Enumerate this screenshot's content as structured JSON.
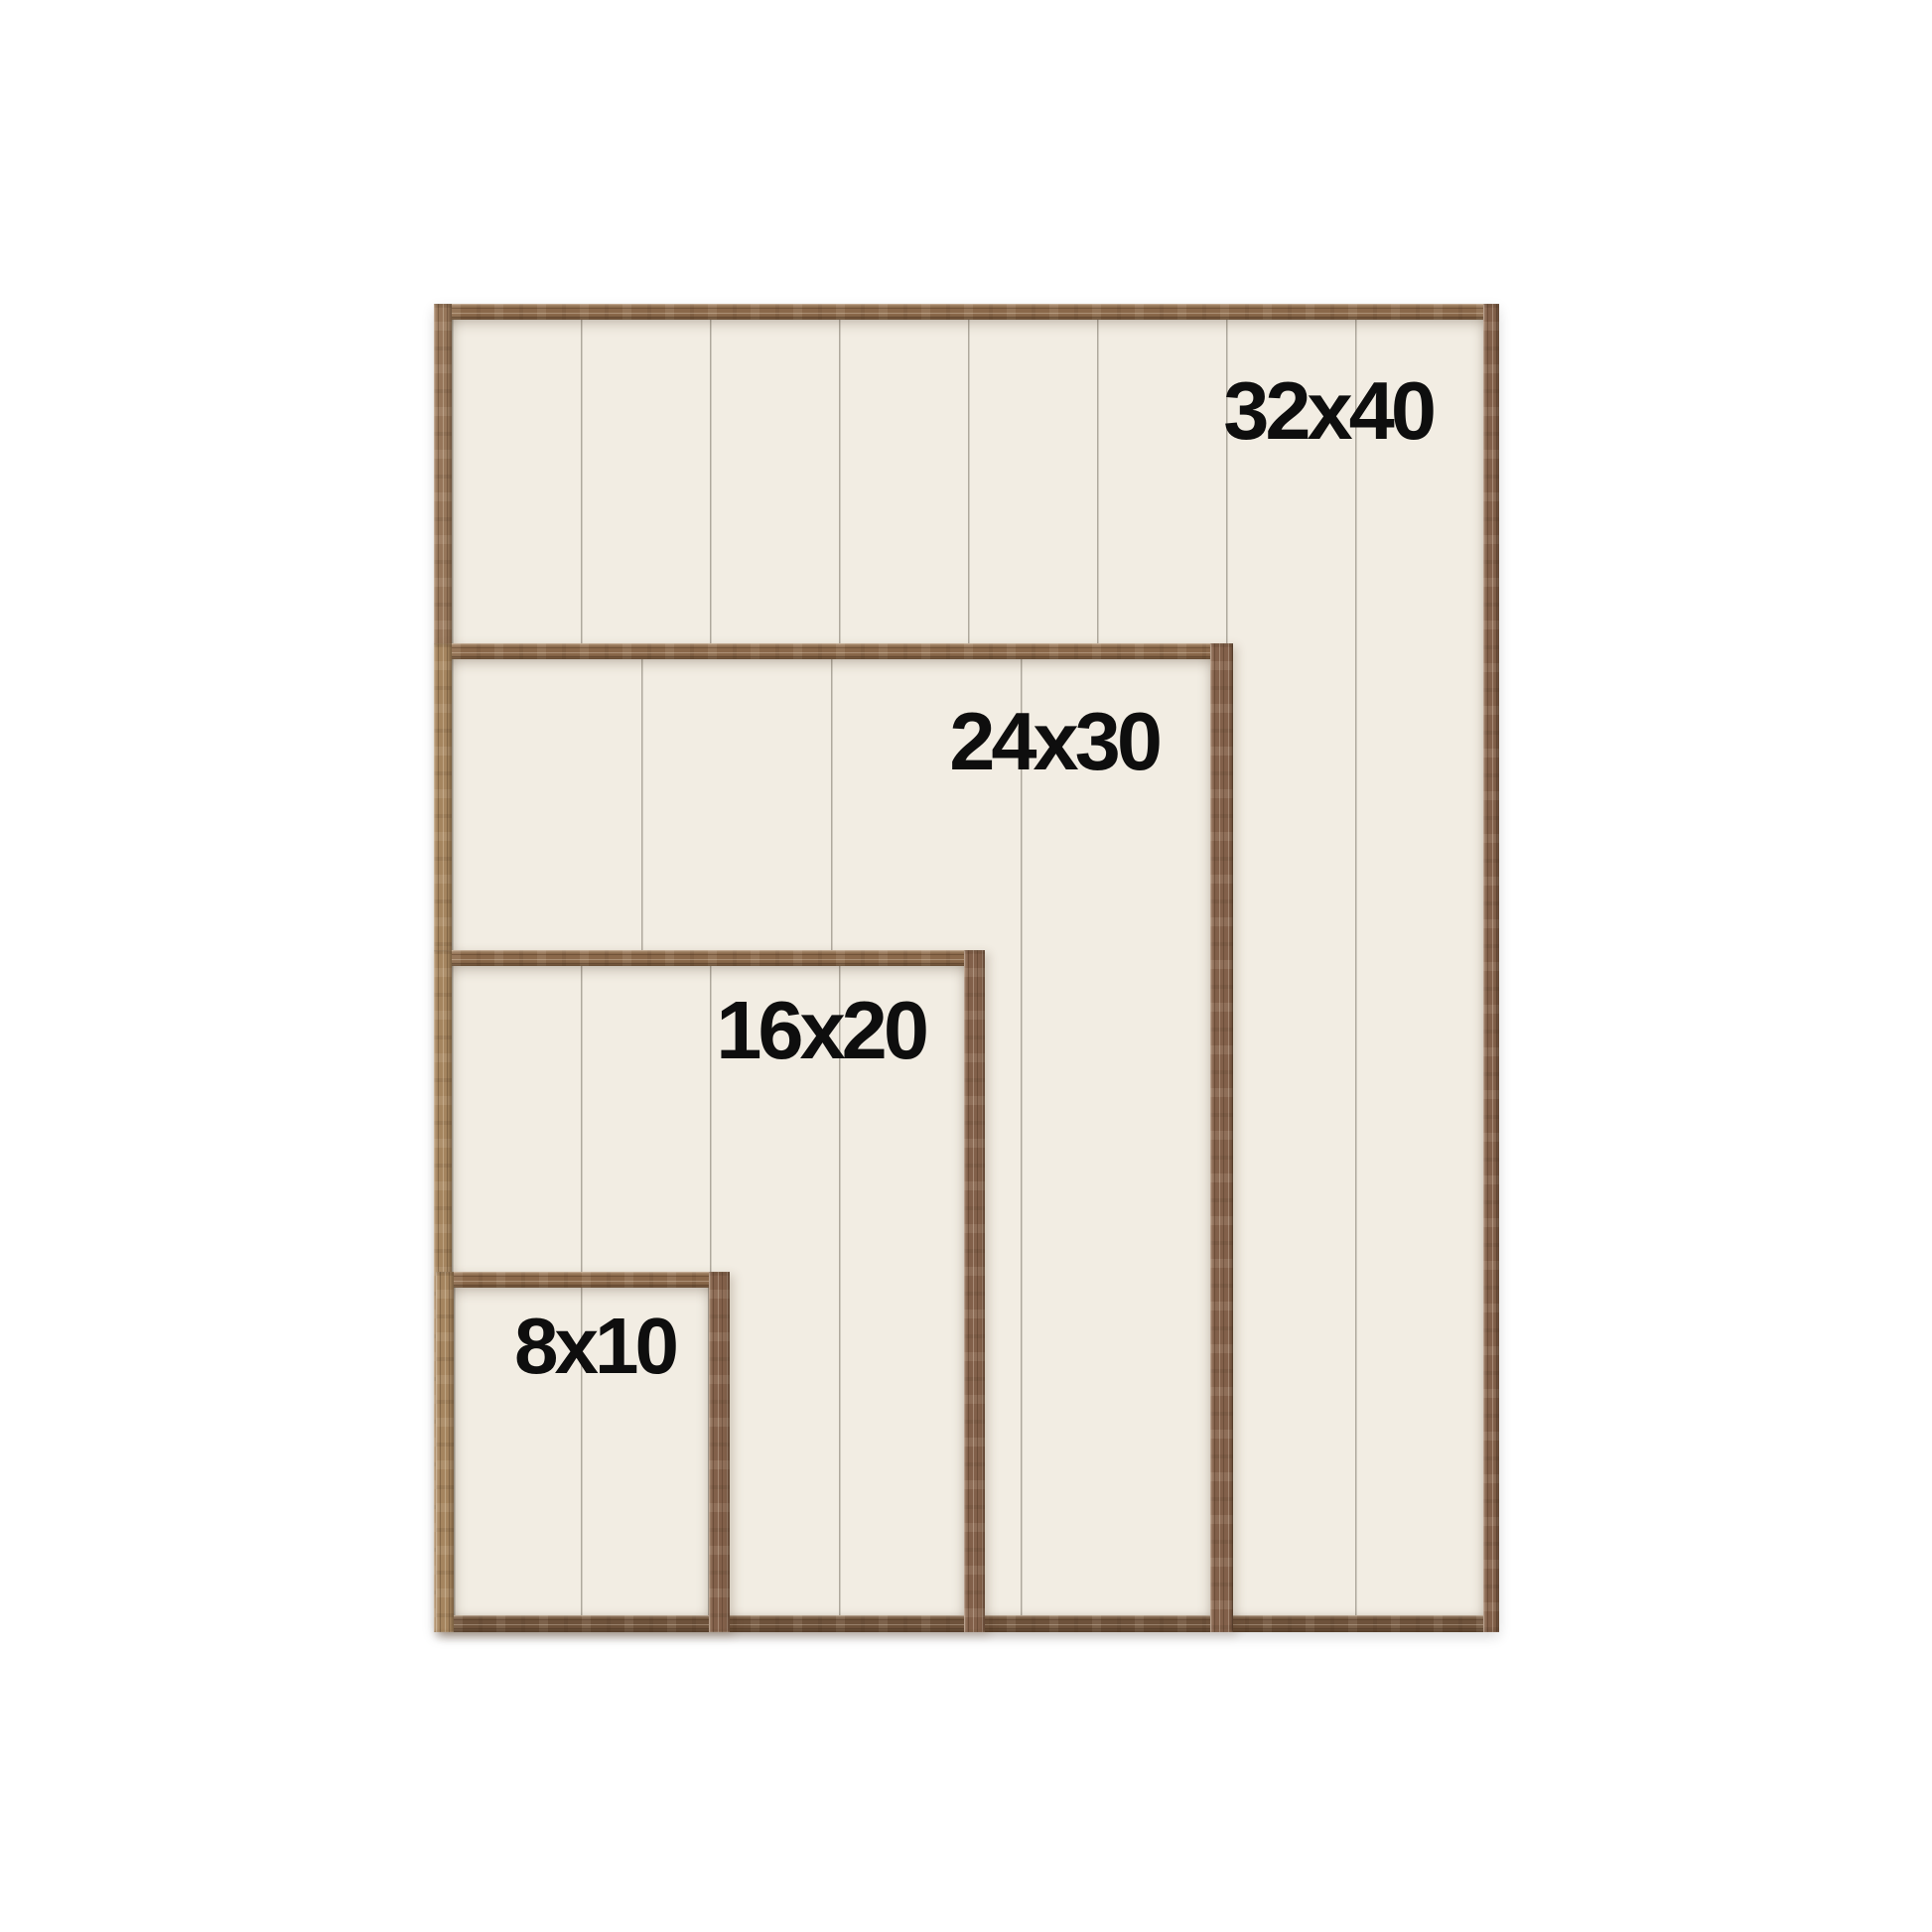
{
  "frames": [
    {
      "label": "32x40"
    },
    {
      "label": "24x30"
    },
    {
      "label": "16x20"
    },
    {
      "label": "8x10"
    }
  ],
  "colors": {
    "background": "#ffffff",
    "wood": "#8a684a",
    "wood_dark": "#6e523b",
    "wood_light": "#a5855f",
    "panel": "#f2ede3",
    "plank_line": "#787164",
    "label_text": "#0e0e0e"
  }
}
